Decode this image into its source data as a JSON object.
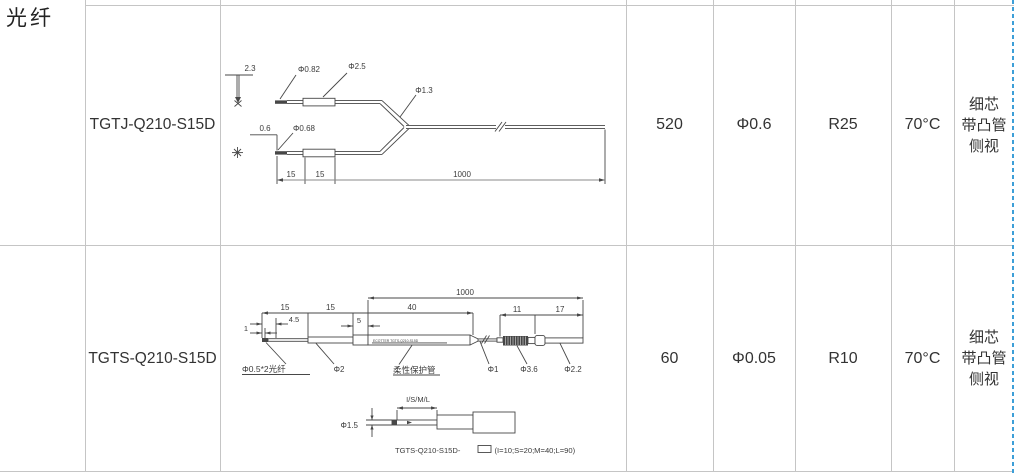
{
  "category_label": "光纤",
  "page_break_color": "#3d9fd8",
  "rows": [
    {
      "model": "TGTJ-Q210-S15D",
      "values": [
        "520",
        "Φ0.6",
        "R25",
        "70°C"
      ],
      "view": [
        "细芯",
        "带凸管",
        "侧视"
      ],
      "drawing": {
        "dim_2_3": "2.3",
        "dim_phi082": "Φ0.82",
        "dim_phi25": "Φ2.5",
        "dim_phi13": "Φ1.3",
        "dim_06": "0.6",
        "dim_phi068": "Φ0.68",
        "dim_15a": "15",
        "dim_15b": "15",
        "dim_1000": "1000"
      }
    },
    {
      "model": "TGTS-Q210-S15D",
      "values": [
        "60",
        "Φ0.05",
        "R10",
        "70°C"
      ],
      "view": [
        "细芯",
        "带凸管",
        "侧视"
      ],
      "drawing": {
        "dim_1000": "1000",
        "dim_15a": "15",
        "dim_15b": "15",
        "dim_40": "40",
        "dim_45": "4.5",
        "dim_5": "5",
        "dim_1": "1",
        "dim_11": "11",
        "dim_17": "17",
        "label_fiber": "Φ0.5*2光纤",
        "dim_phi2": "Φ2",
        "label_tube": "柔性保护管",
        "tube_print": "ECOTTER TGTS-Q210-S15D",
        "dim_phi1": "Φ1",
        "dim_phi36": "Φ3.6",
        "dim_phi22": "Φ2.2",
        "dim_isml": "I/S/M/L",
        "dim_phi15": "Φ1.5",
        "order_code": "TGTS-Q210-S15D-",
        "order_code_suffix": "(I=10;S=20;M=40;L=90)"
      }
    }
  ]
}
